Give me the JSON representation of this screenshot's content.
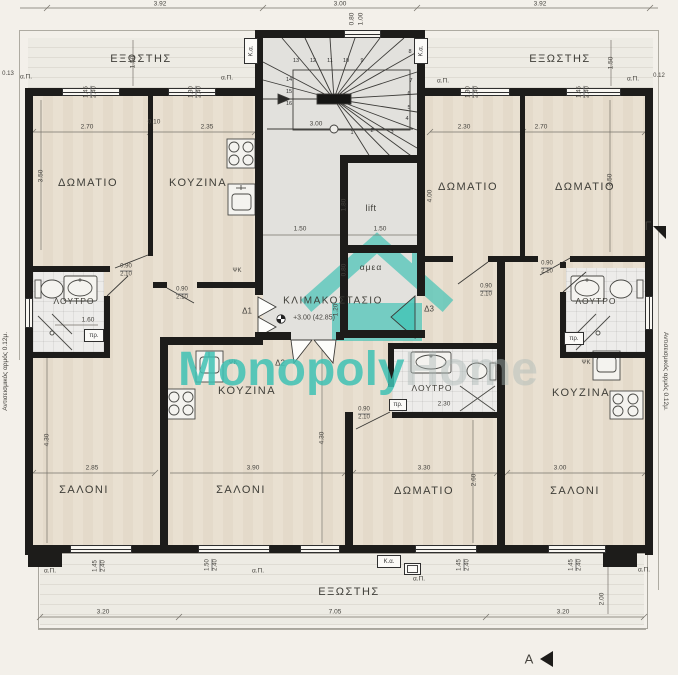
{
  "labels": {
    "balcony": "ΕΞΩΣΤΗΣ",
    "bedroom": "ΔΩΜΑΤΙΟ",
    "kitchen": "ΚΟΥΖΙΝΑ",
    "bathroom": "ΛΟΥΤΡΟ",
    "living": "ΣΑΛΟΝΙ",
    "stairwell": "ΚΛΙΜΑΚΟΣΤΑΣΙΟ",
    "lift": "lift",
    "accessible": "αμεα",
    "level": "+3.00  (42.85)"
  },
  "doors": {
    "d1": "Δ1",
    "d2": "Δ2",
    "d3": "Δ3"
  },
  "annotations": {
    "ap": "α.Π.",
    "ka": "Κ.α.",
    "pr": "πρ.",
    "psk": "ΨΚ",
    "seismic": "Αντισεισμικός αρμός 0.12μ.",
    "section_a": "Α",
    "section_g": "Γ",
    "offset_left": "0.13",
    "offset_right": "0.12"
  },
  "dims": {
    "v010": "0.10",
    "v080": "0.80",
    "v090": "0.90",
    "v100": "1.00",
    "v120": "1.20",
    "v130": "1.30",
    "v145": "1.45",
    "v150": "1.50",
    "v160": "1.60",
    "v180": "1.80",
    "v200": "2.00",
    "v210": "2.10",
    "v230": "2.30",
    "v235": "2.35",
    "v240": "2.40",
    "v260": "2.60",
    "v270": "2.70",
    "v285": "2.85",
    "v300": "3.00",
    "v320": "3.20",
    "v330": "3.30",
    "v350": "3.50",
    "v390": "3.90",
    "v392": "3.92",
    "v400": "4.00",
    "v430": "4.30",
    "v705": "7.05"
  },
  "stairs": {
    "steps": [
      "1",
      "2",
      "3",
      "4",
      "5",
      "6",
      "7",
      "8",
      "9",
      "10",
      "11",
      "12",
      "13",
      "14",
      "15",
      "16"
    ]
  },
  "watermark": {
    "primary": "Monopoly",
    "secondary": "Home",
    "accent": "#3fc2b5"
  }
}
